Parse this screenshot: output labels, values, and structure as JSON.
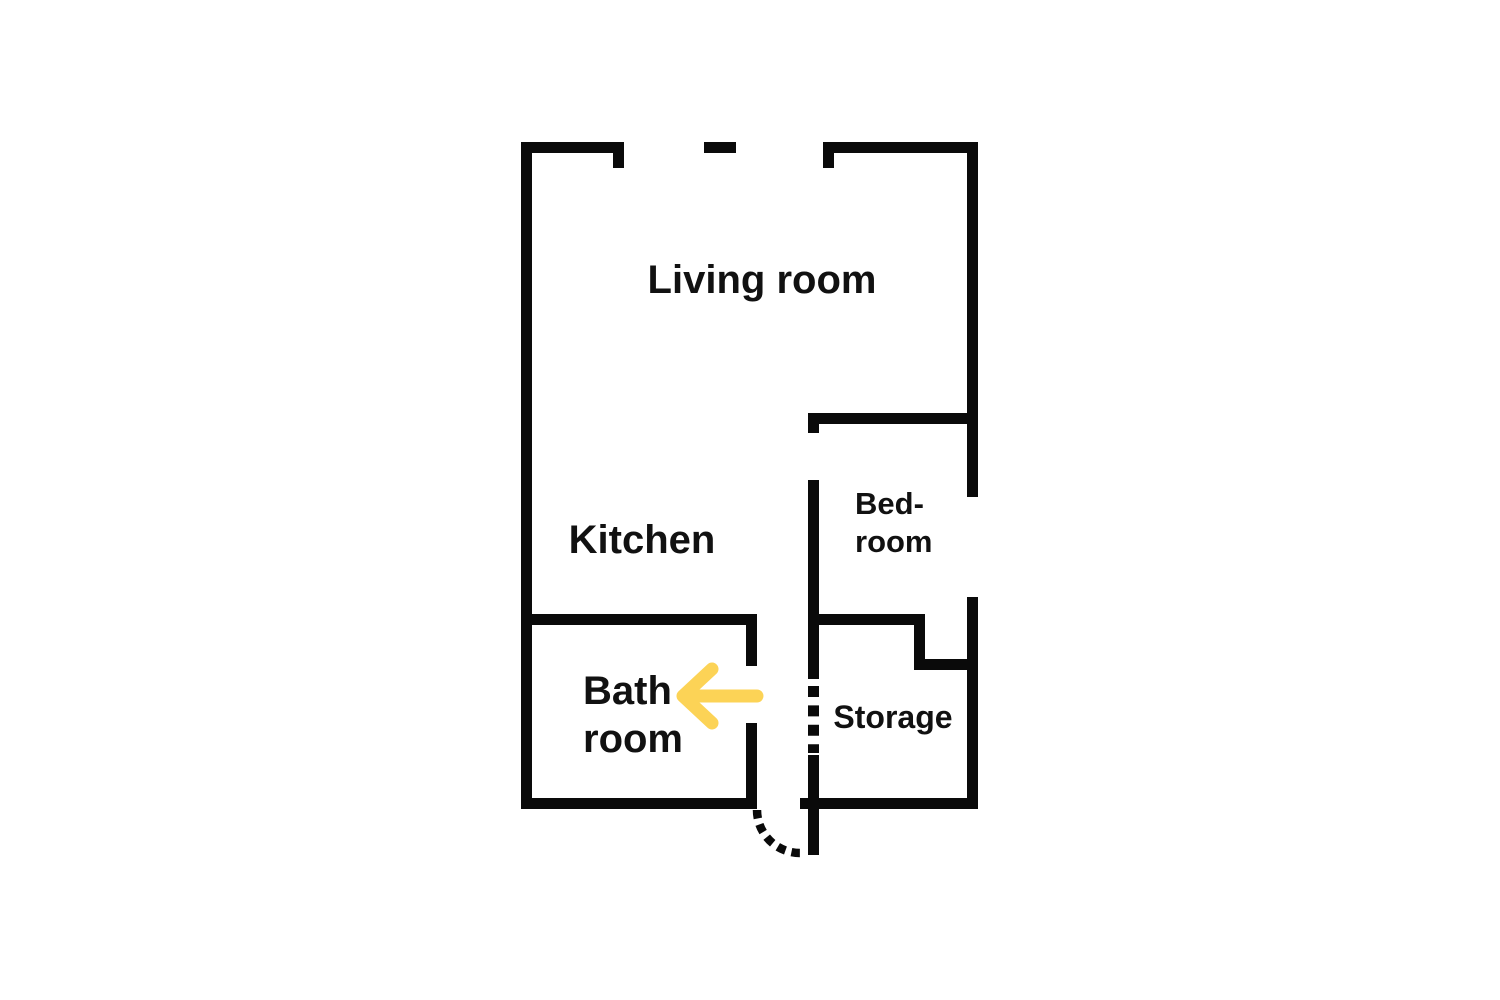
{
  "page": {
    "background_color": "#ffffff"
  },
  "floor_plan": {
    "wall_color": "#0a0a0a",
    "text_color": "#111111",
    "rooms": {
      "living_room": {
        "label": "Living room"
      },
      "kitchen": {
        "label": "Kitchen"
      },
      "bedroom": {
        "line1": "Bed-",
        "line2": "room"
      },
      "bathroom": {
        "line1": "Bath",
        "line2": "room"
      },
      "storage": {
        "label": "Storage"
      }
    },
    "annotations": {
      "arrow": {
        "color": "#fcd356",
        "direction": "left",
        "points_to": "Bath room"
      }
    }
  }
}
